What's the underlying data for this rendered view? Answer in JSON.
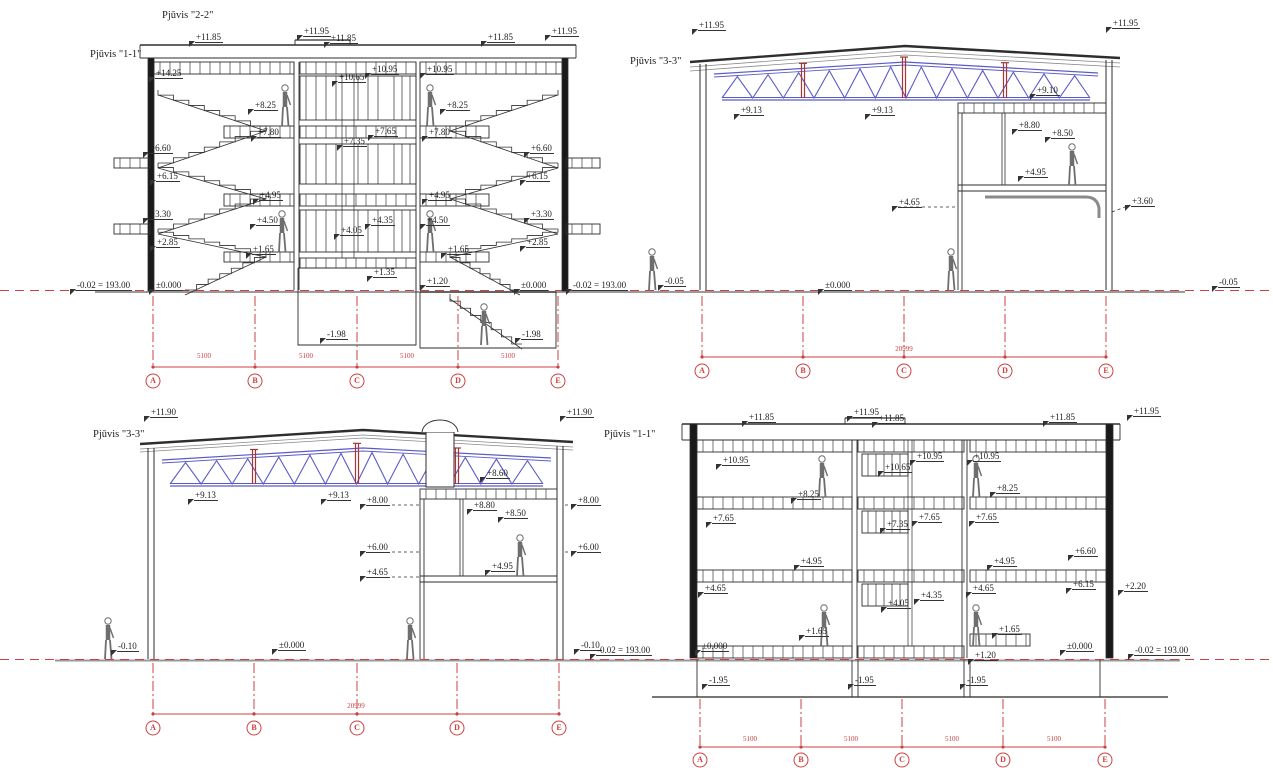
{
  "document": {
    "type": "architectural section drawings",
    "language": "Lithuanian"
  },
  "colors": {
    "paper": "#ffffff",
    "ink": "#2e2e2e",
    "truss_blue": "#5a5ac8",
    "post_red": "#a83434",
    "grid_red": "#cc4040",
    "ground_gray": "#9a9a9a",
    "figure_gray": "#6e6e6e"
  },
  "sections": {
    "top_left": {
      "title_top": "Pjūvis \"2-2\"",
      "title_side": "Pjūvis \"1-1\"",
      "elevations": [
        "+11.85",
        "+11.95",
        "+11.85",
        "+11.85",
        "+11.95",
        "+14.25",
        "+10.65",
        "+10.95",
        "+10.95",
        "+8.25",
        "+8.25",
        "+7.80",
        "+7.35",
        "+7.65",
        "+7.80",
        "+6.60",
        "+6.15",
        "+6.60",
        "+6.15",
        "+4.95",
        "+4.95",
        "+4.50",
        "+4.05",
        "+4.35",
        "+4.50",
        "+3.30",
        "+2.85",
        "+3.30",
        "+2.85",
        "+1.65",
        "+1.65",
        "+1.35",
        "+1.20",
        "±0.000",
        "±0.000",
        "-0.02 = 193.00",
        "-0.02 = 193.00",
        "-1.98",
        "-1.98"
      ],
      "grid_letters": [
        "A",
        "B",
        "C",
        "D",
        "E"
      ],
      "bay_dims": [
        "5100",
        "5100",
        "5100",
        "5100"
      ]
    },
    "top_right": {
      "title_side": "Pjūvis \"3-3\"",
      "elevations": [
        "+11.95",
        "+11.95",
        "+9.13",
        "+9.13",
        "+9.10",
        "+8.80",
        "+8.50",
        "+4.95",
        "+4.65",
        "+3.60",
        "±0.000",
        "-0.05",
        "-0.05"
      ],
      "grid_letters": [
        "A",
        "B",
        "C",
        "D",
        "E"
      ],
      "total_dim": "20999"
    },
    "bottom_left": {
      "title_side": "Pjūvis \"3-3\"",
      "elevations": [
        "+11.90",
        "+11.90",
        "+9.13",
        "+9.13",
        "+8.60",
        "+8.00",
        "+8.00",
        "+8.80",
        "+8.50",
        "+6.00",
        "+6.00",
        "+4.65",
        "+4.95",
        "±0.000",
        "-0.10",
        "-0.10",
        "-0.02 = 193.00"
      ],
      "grid_letters": [
        "A",
        "B",
        "C",
        "D",
        "E"
      ],
      "total_dim": "20999"
    },
    "bottom_right": {
      "title_side": "Pjūvis \"1-1\"",
      "elevations": [
        "+11.85",
        "+11.95",
        "+11.85",
        "+11.85",
        "+11.95",
        "+10.95",
        "+10.65",
        "+10.95",
        "+10.95",
        "+8.25",
        "+8.25",
        "+7.65",
        "+7.35",
        "+7.65",
        "+7.65",
        "+6.60",
        "+6.15",
        "+2.20",
        "+4.95",
        "+4.95",
        "+4.65",
        "+4.05",
        "+4.35",
        "+4.65",
        "+1.65",
        "+1.65",
        "+1.20",
        "±0.000",
        "±0.000",
        "-0.02 = 193.00",
        "-1.95",
        "-1.95",
        "-1.95"
      ],
      "grid_letters": [
        "A",
        "B",
        "C",
        "D",
        "E"
      ],
      "bay_dims": [
        "5100",
        "5100",
        "5100",
        "5100"
      ]
    }
  }
}
